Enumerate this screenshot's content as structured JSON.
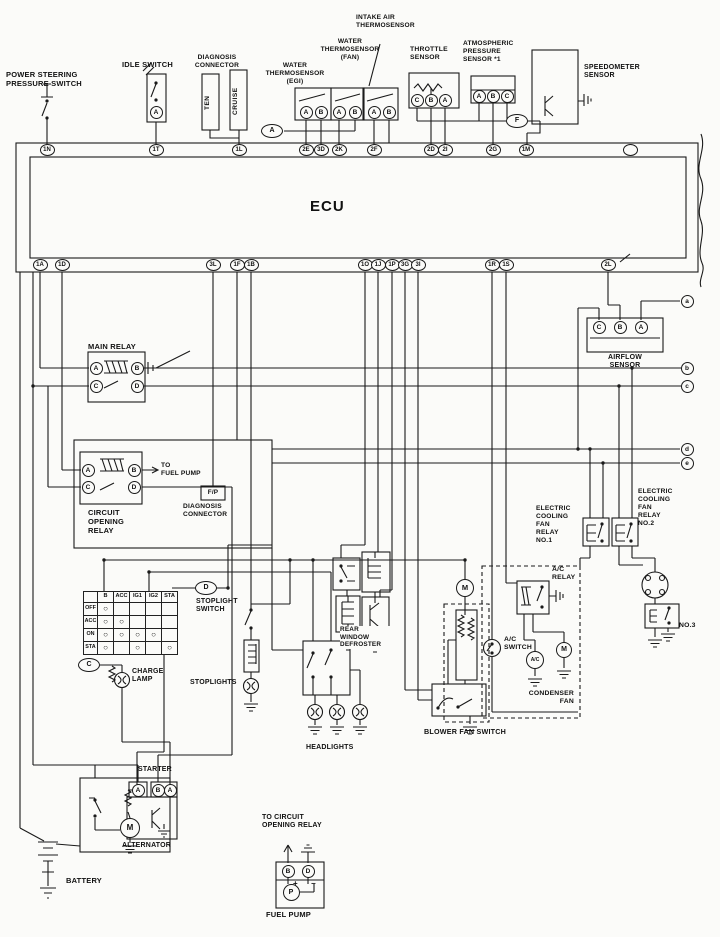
{
  "colors": {
    "ink": "#1a1a1a",
    "paper": "#fbfbf9"
  },
  "labels": {
    "power_steering": "POWER STEERING\nPRESSURE SWITCH",
    "idle_switch": "IDLE SWITCH",
    "diagnosis_connector": "DIAGNOSIS\nCONNECTOR",
    "ten": "TEN",
    "cruise": "CRUISE",
    "water_egi": "WATER\nTHERMOSENSOR\n(EGI)",
    "water_fan": "WATER\nTHERMOSENSOR\n(FAN)",
    "intake_air": "INTAKE AIR\nTHERMOSENSOR",
    "throttle": "THROTTLE\nSENSOR",
    "atmospheric": "ATMOSPHERIC\nPRESSURE\nSENSOR *1",
    "speedometer": "SPEEDOMETER\nSENSOR",
    "ecu": "ECU",
    "airflow": "AIRFLOW\nSENSOR",
    "main_relay": "MAIN RELAY",
    "circuit_opening_relay": "CIRCUIT\nOPENING\nRELAY",
    "to_fuel_pump": "TO\nFUEL PUMP",
    "fp": "F/P",
    "fp_diagnosis": "DIAGNOSIS\nCONNECTOR",
    "stoplight_switch": "STOPLIGHT\nSWITCH",
    "stoplights": "STOPLIGHTS",
    "charge_lamp": "CHARGE\nLAMP",
    "rear_defroster": "REAR\nWINDOW\nDEFROSTER",
    "headlights": "HEADLIGHTS",
    "blower_fan_switch": "BLOWER FAN SWITCH",
    "ac_relay": "A/C\nRELAY",
    "ac_switch": "A/C\nSWITCH",
    "ac_clutch": "A/C",
    "condenser_fan": "CONDENSER\nFAN",
    "cooling_fan_relay1": "ELECTRIC\nCOOLING\nFAN\nRELAY\nNO.1",
    "cooling_fan_relay2": "ELECTRIC\nCOOLING\nFAN\nRELAY\nNO.2",
    "no3": "NO.3",
    "starter": "STARTER",
    "alternator": "ALTERNATOR",
    "battery": "BATTERY",
    "to_circuit_opening_relay": "TO CIRCUIT\nOPENING RELAY",
    "fuel_pump": "FUEL PUMP"
  },
  "pins": {
    "top": [
      "1N",
      "1T",
      "1L",
      "2E",
      "3D",
      "2K",
      "2F",
      "2D",
      "2I",
      "2G",
      "1M"
    ],
    "bottom": [
      "1A",
      "1D",
      "3L",
      "1F",
      "1B",
      "1O",
      "1J",
      "1P",
      "3G",
      "3I",
      "1R",
      "1S",
      "2L"
    ]
  },
  "terminals": {
    "idle": "A",
    "egi": [
      "A",
      "B"
    ],
    "fan": [
      "A",
      "B"
    ],
    "intake": [
      "A",
      "B"
    ],
    "throttle": [
      "C",
      "B",
      "A"
    ],
    "atmospheric": [
      "A",
      "B",
      "C"
    ],
    "airflow": [
      "C",
      "B",
      "A"
    ],
    "main_relay": [
      "A",
      "B",
      "C",
      "D"
    ],
    "cor": [
      "A",
      "B",
      "C",
      "D"
    ],
    "alternator": [
      "A",
      "B",
      "A"
    ],
    "fuel_pump": [
      "B",
      "D",
      "P"
    ],
    "motor": "M"
  },
  "junctions": {
    "a_ref": "A",
    "f_ref": "F",
    "c_ref": "C",
    "d_ref": "D",
    "edge": [
      "a",
      "b",
      "c",
      "d",
      "e"
    ]
  },
  "ignition_table": {
    "headers": [
      "B",
      "ACC",
      "IG1",
      "IG2",
      "STA"
    ],
    "rows": [
      {
        "label": "OFF",
        "marks": [
          "○",
          "",
          "",
          "",
          ""
        ]
      },
      {
        "label": "ACC",
        "marks": [
          "○",
          "○",
          "",
          "",
          ""
        ]
      },
      {
        "label": "ON",
        "marks": [
          "○",
          "○",
          "○",
          "○",
          ""
        ]
      },
      {
        "label": "STA",
        "marks": [
          "○",
          "",
          "○",
          "",
          "○"
        ]
      }
    ]
  },
  "symbols": {
    "plus": "+",
    "minus": "−"
  }
}
